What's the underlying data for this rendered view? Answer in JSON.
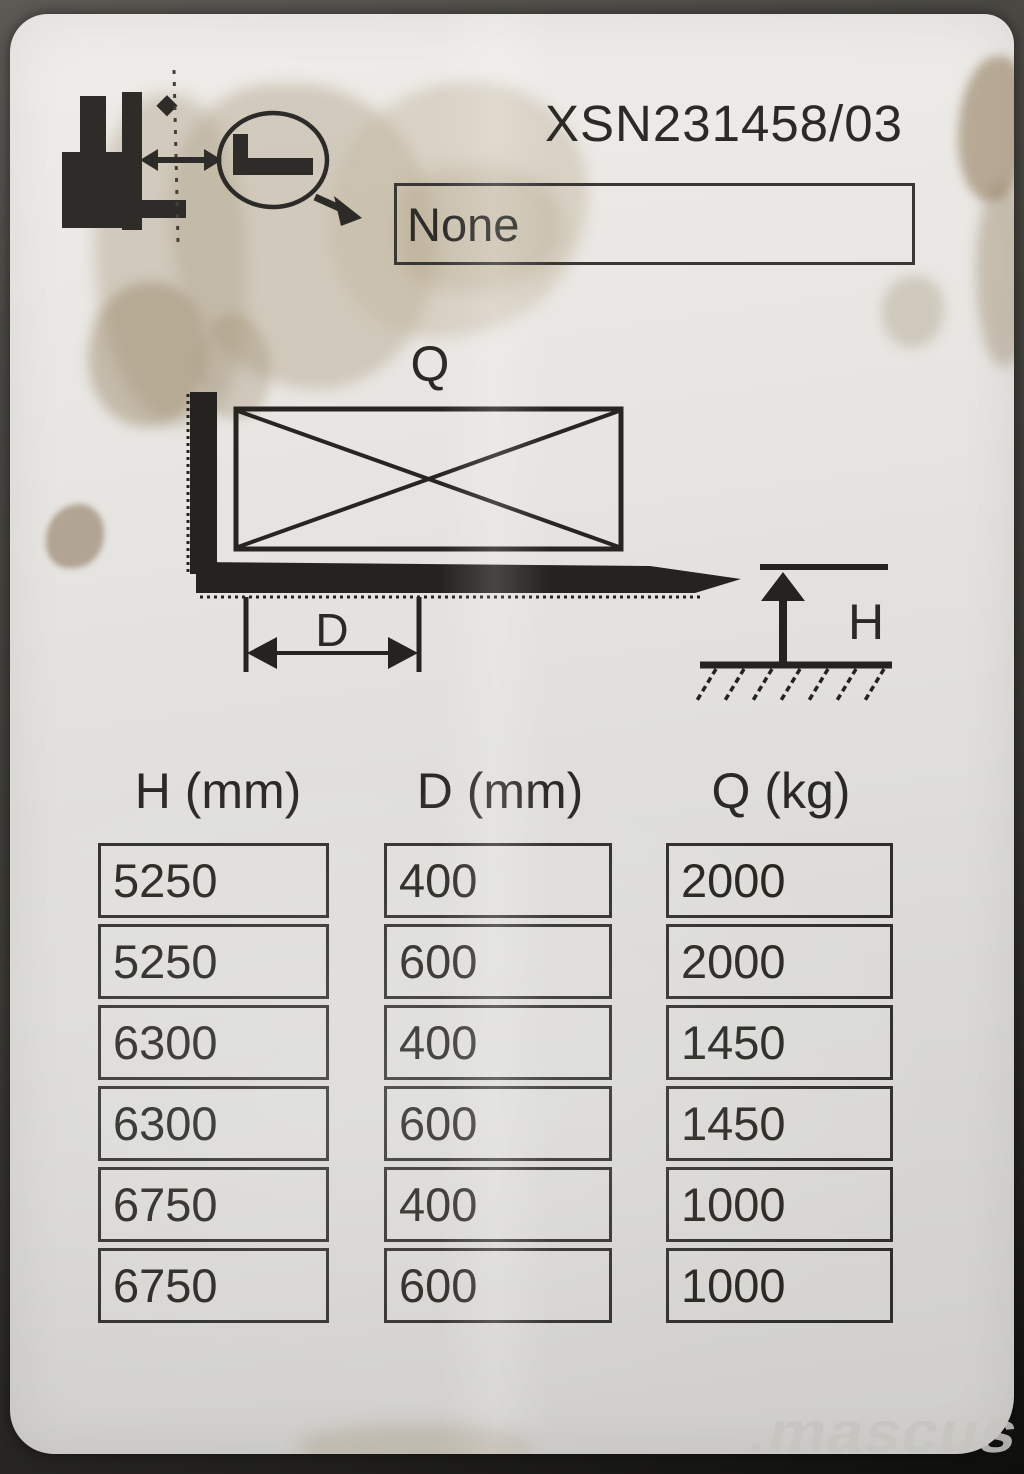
{
  "plate": {
    "serial_number": "XSN231458/03",
    "attachment_field_value": "None",
    "diagram": {
      "load_label": "Q",
      "load_center_label": "D",
      "lift_height_label": "H"
    },
    "capacity_table": {
      "headers": [
        "H (mm)",
        "D (mm)",
        "Q (kg)"
      ],
      "rows": [
        [
          "5250",
          "400",
          "2000"
        ],
        [
          "5250",
          "600",
          "2000"
        ],
        [
          "6300",
          "400",
          "1450"
        ],
        [
          "6300",
          "600",
          "1450"
        ],
        [
          "6750",
          "400",
          "1000"
        ],
        [
          "6750",
          "600",
          "1000"
        ]
      ]
    }
  },
  "watermark": {
    "text": ".mascus"
  },
  "colors": {
    "ink": "#2d2b27",
    "plate": "#e3e1dd",
    "backdrop": "#3a3934",
    "stain": "#b3a183",
    "watermark": "#c7c5c0"
  }
}
